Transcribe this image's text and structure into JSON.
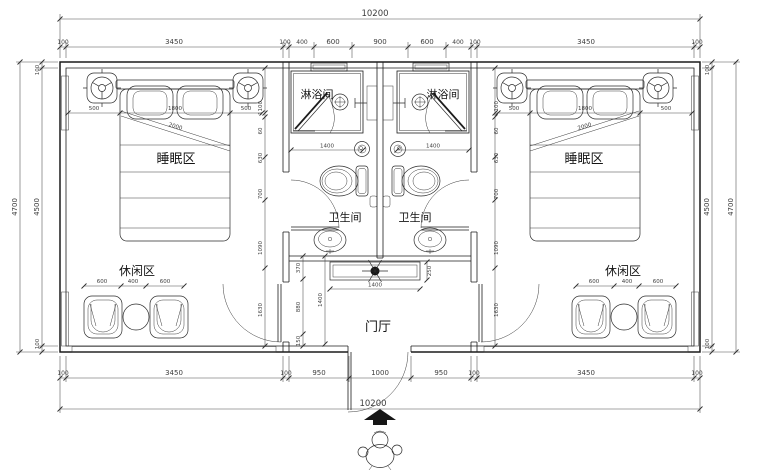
{
  "plan": {
    "title": "twin-guest-room-floor-plan",
    "room_labels": {
      "sleeping": "睡眠区",
      "leisure": "休闲区",
      "shower": "淋浴间",
      "wc": "卫生间",
      "foyer": "门厅"
    },
    "dims": {
      "overall_top": "10200",
      "overall_bottom": "10200",
      "top_row": [
        "100",
        "3450",
        "100",
        "400",
        "600",
        "900",
        "600",
        "400",
        "100",
        "3450",
        "100"
      ],
      "bottom_row": [
        "100",
        "3450",
        "100",
        "950",
        "1000",
        "950",
        "100",
        "3450",
        "100"
      ],
      "left_outer": "4700",
      "left_row": [
        "100",
        "4500",
        "100"
      ],
      "right_row": [
        "100",
        "4500",
        "100"
      ],
      "right_outer": "4700",
      "bed_row": [
        "500",
        "1800",
        "500"
      ],
      "bed_diag": "2000",
      "leisure_row": [
        "600",
        "400",
        "600"
      ],
      "shower_width": "1400",
      "side_chain": [
        "1100",
        "60",
        "630",
        "700",
        "1090",
        "1630"
      ],
      "foyer_chain": [
        "370",
        "880",
        "150"
      ],
      "foyer_depth": "1400",
      "console_width": "1400",
      "console_depth": "250"
    },
    "colors": {
      "line": "#1c1c1c",
      "dim": "#4a4a4a",
      "bg": "#ffffff"
    }
  }
}
